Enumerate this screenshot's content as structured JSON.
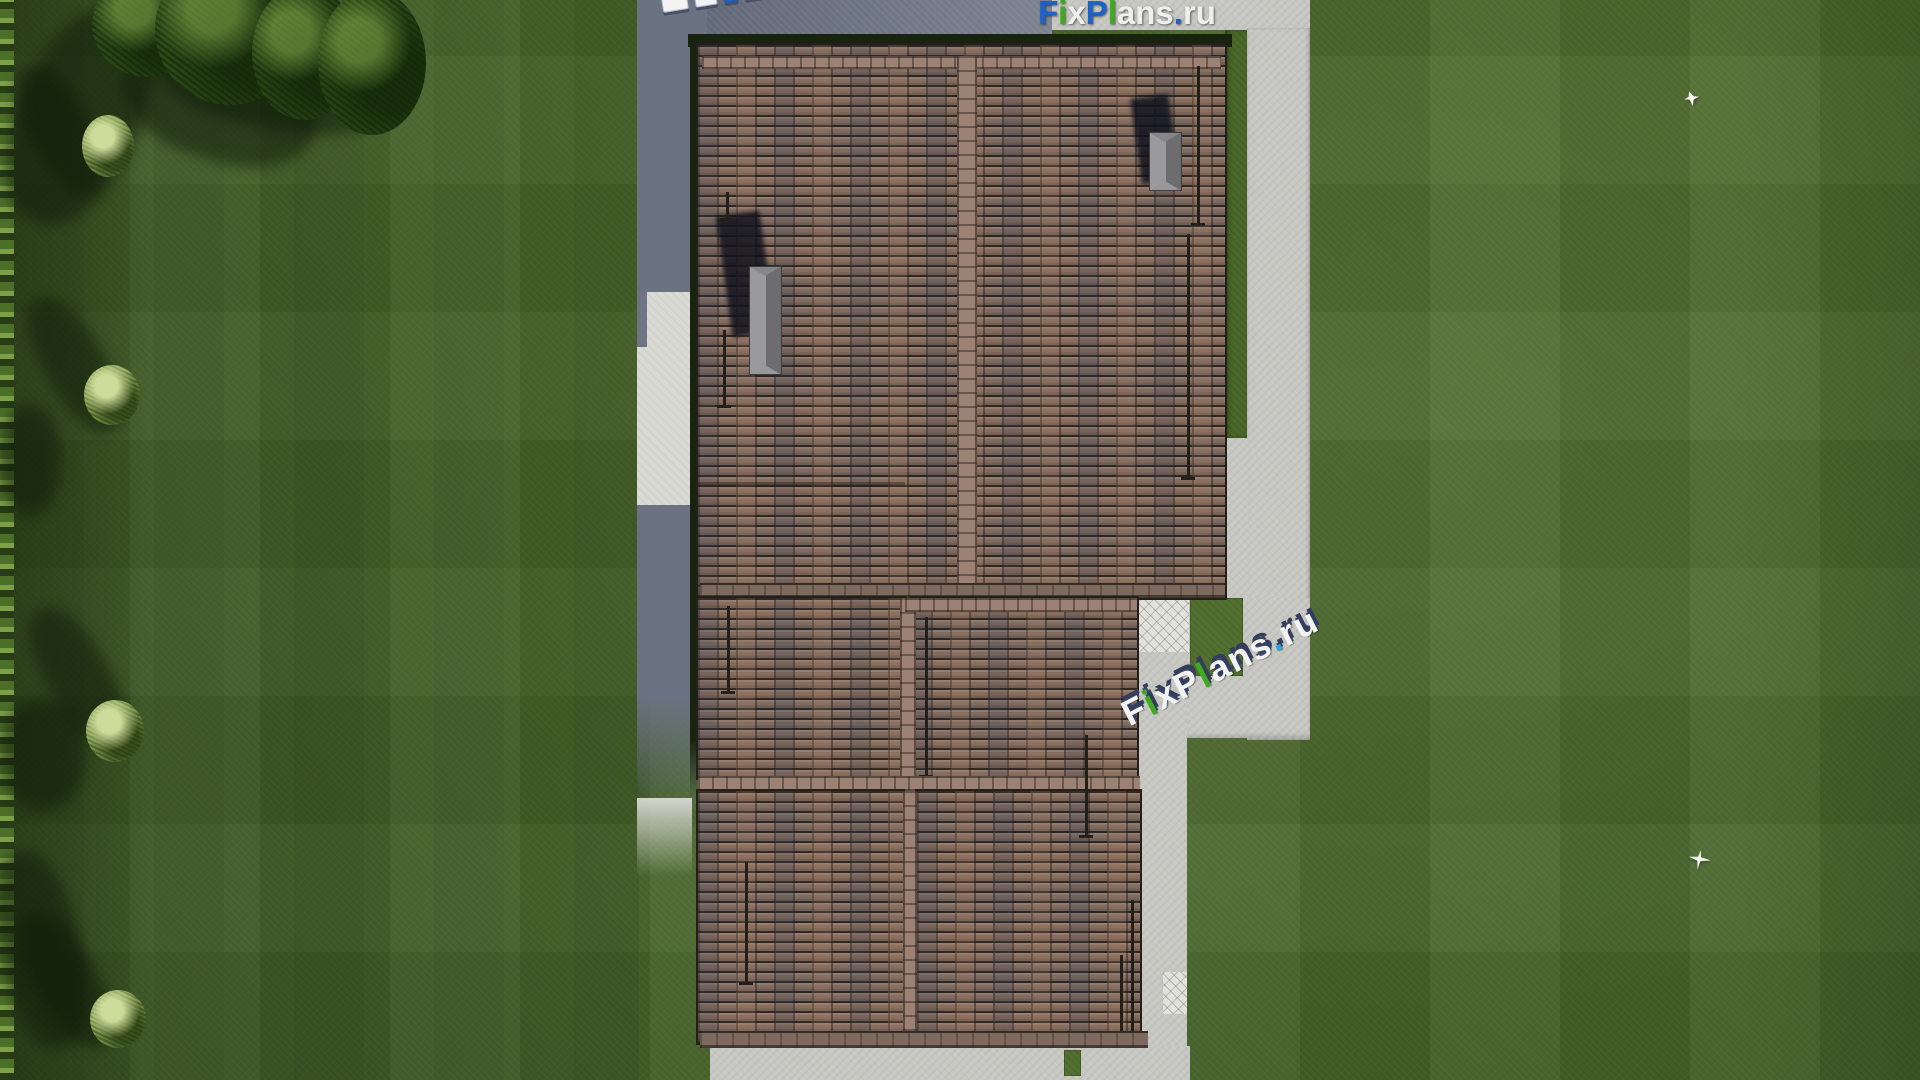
{
  "site": {
    "brand_text": "FixPlans.ru"
  },
  "palette": {
    "blue": "#1d63c6",
    "green": "#3dab1d",
    "white": "#efefef",
    "white3d": "#f3f3f3",
    "lightblue": "#29a4e2",
    "navy_extrusion": "#343e5c",
    "grass": "#4c692c",
    "roof_tile": "#8b7365",
    "roof_ridge": "#9c8275",
    "pavement": "#c7c7c2",
    "house_shadow": "#6d7483",
    "chimney_gray": "#8a8a8c"
  },
  "watermarks": {
    "logo_top_flat": {
      "text": "FixPlans.ru",
      "parts": [
        {
          "t": "F",
          "c": "blue"
        },
        {
          "t": "i",
          "c": "green"
        },
        {
          "t": "x",
          "c": "white"
        },
        {
          "t": "P",
          "c": "blue"
        },
        {
          "t": "l",
          "c": "green"
        },
        {
          "t": "ans",
          "c": "white"
        },
        {
          "t": ".",
          "c": "blue"
        },
        {
          "t": "ru",
          "c": "white"
        }
      ]
    },
    "logo_mid_3d": {
      "text": "FixPlans.ru",
      "parts": [
        {
          "t": "F",
          "c": "white3d"
        },
        {
          "t": "i",
          "c": "green"
        },
        {
          "t": "x",
          "c": "white3d"
        },
        {
          "t": "P",
          "c": "white3d"
        },
        {
          "t": "l",
          "c": "green"
        },
        {
          "t": "ans",
          "c": "white3d"
        },
        {
          "t": ".",
          "c": "lightblue"
        },
        {
          "t": "ru",
          "c": "white3d"
        }
      ]
    },
    "logo_top_3d_blocks": [
      "white3d",
      "white3d",
      "blue",
      "white3d",
      "white3d",
      "white3d",
      "white3d"
    ]
  }
}
